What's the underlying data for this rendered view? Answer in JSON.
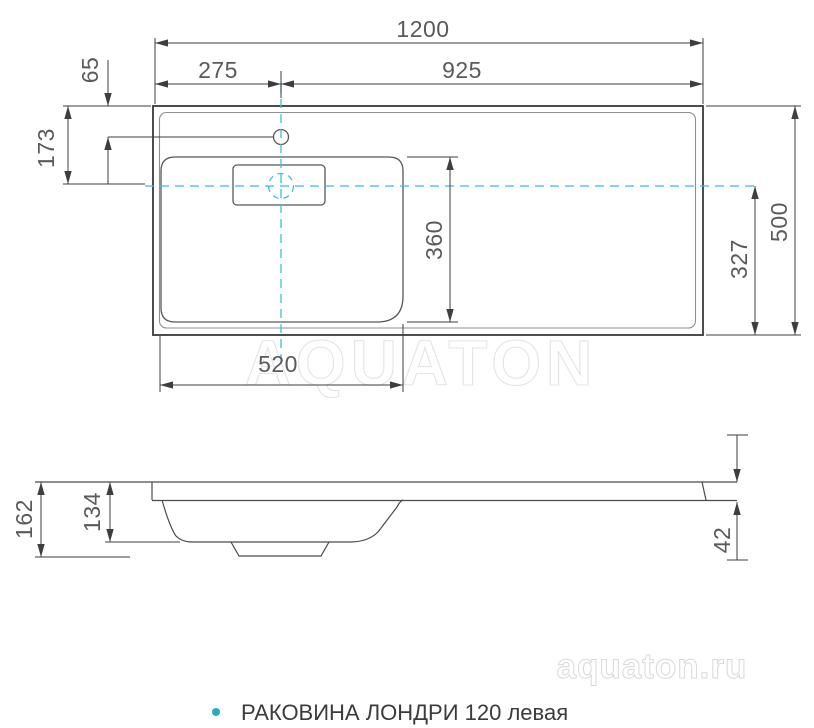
{
  "page": {
    "background": "#ffffff",
    "colors": {
      "dimension_text": "#5a5a5c",
      "dimension_line": "#3e3e40",
      "sink_outline": "#434446",
      "sink_inner_line": "#8d8f91",
      "basin_line": "#55575a",
      "centerline": "#3fbdd8",
      "bullet": "#2aa9bf",
      "watermark": "#e4e4e6"
    },
    "top_view": {
      "name": "top view of sink",
      "dimensions": {
        "overall_width": "1200",
        "hole_to_right_edge": "925",
        "left_edge_to_hole": "275",
        "top_edge_to_hole": "65",
        "top_edge_to_centerline": "173",
        "basin_depth": "360",
        "centerline_to_bottom_edge": "327",
        "overall_depth": "500",
        "basin_width": "520"
      }
    },
    "side_view": {
      "name": "side profile of sink",
      "dimensions": {
        "overall_height": "162",
        "bowl_depth": "134",
        "rim_thickness": "42"
      }
    },
    "watermarks": {
      "center": "AQUATON",
      "corner": "aquaton.ru"
    },
    "footer": {
      "label": "РАКОВИНА ЛОНДРИ 120 левая"
    }
  }
}
